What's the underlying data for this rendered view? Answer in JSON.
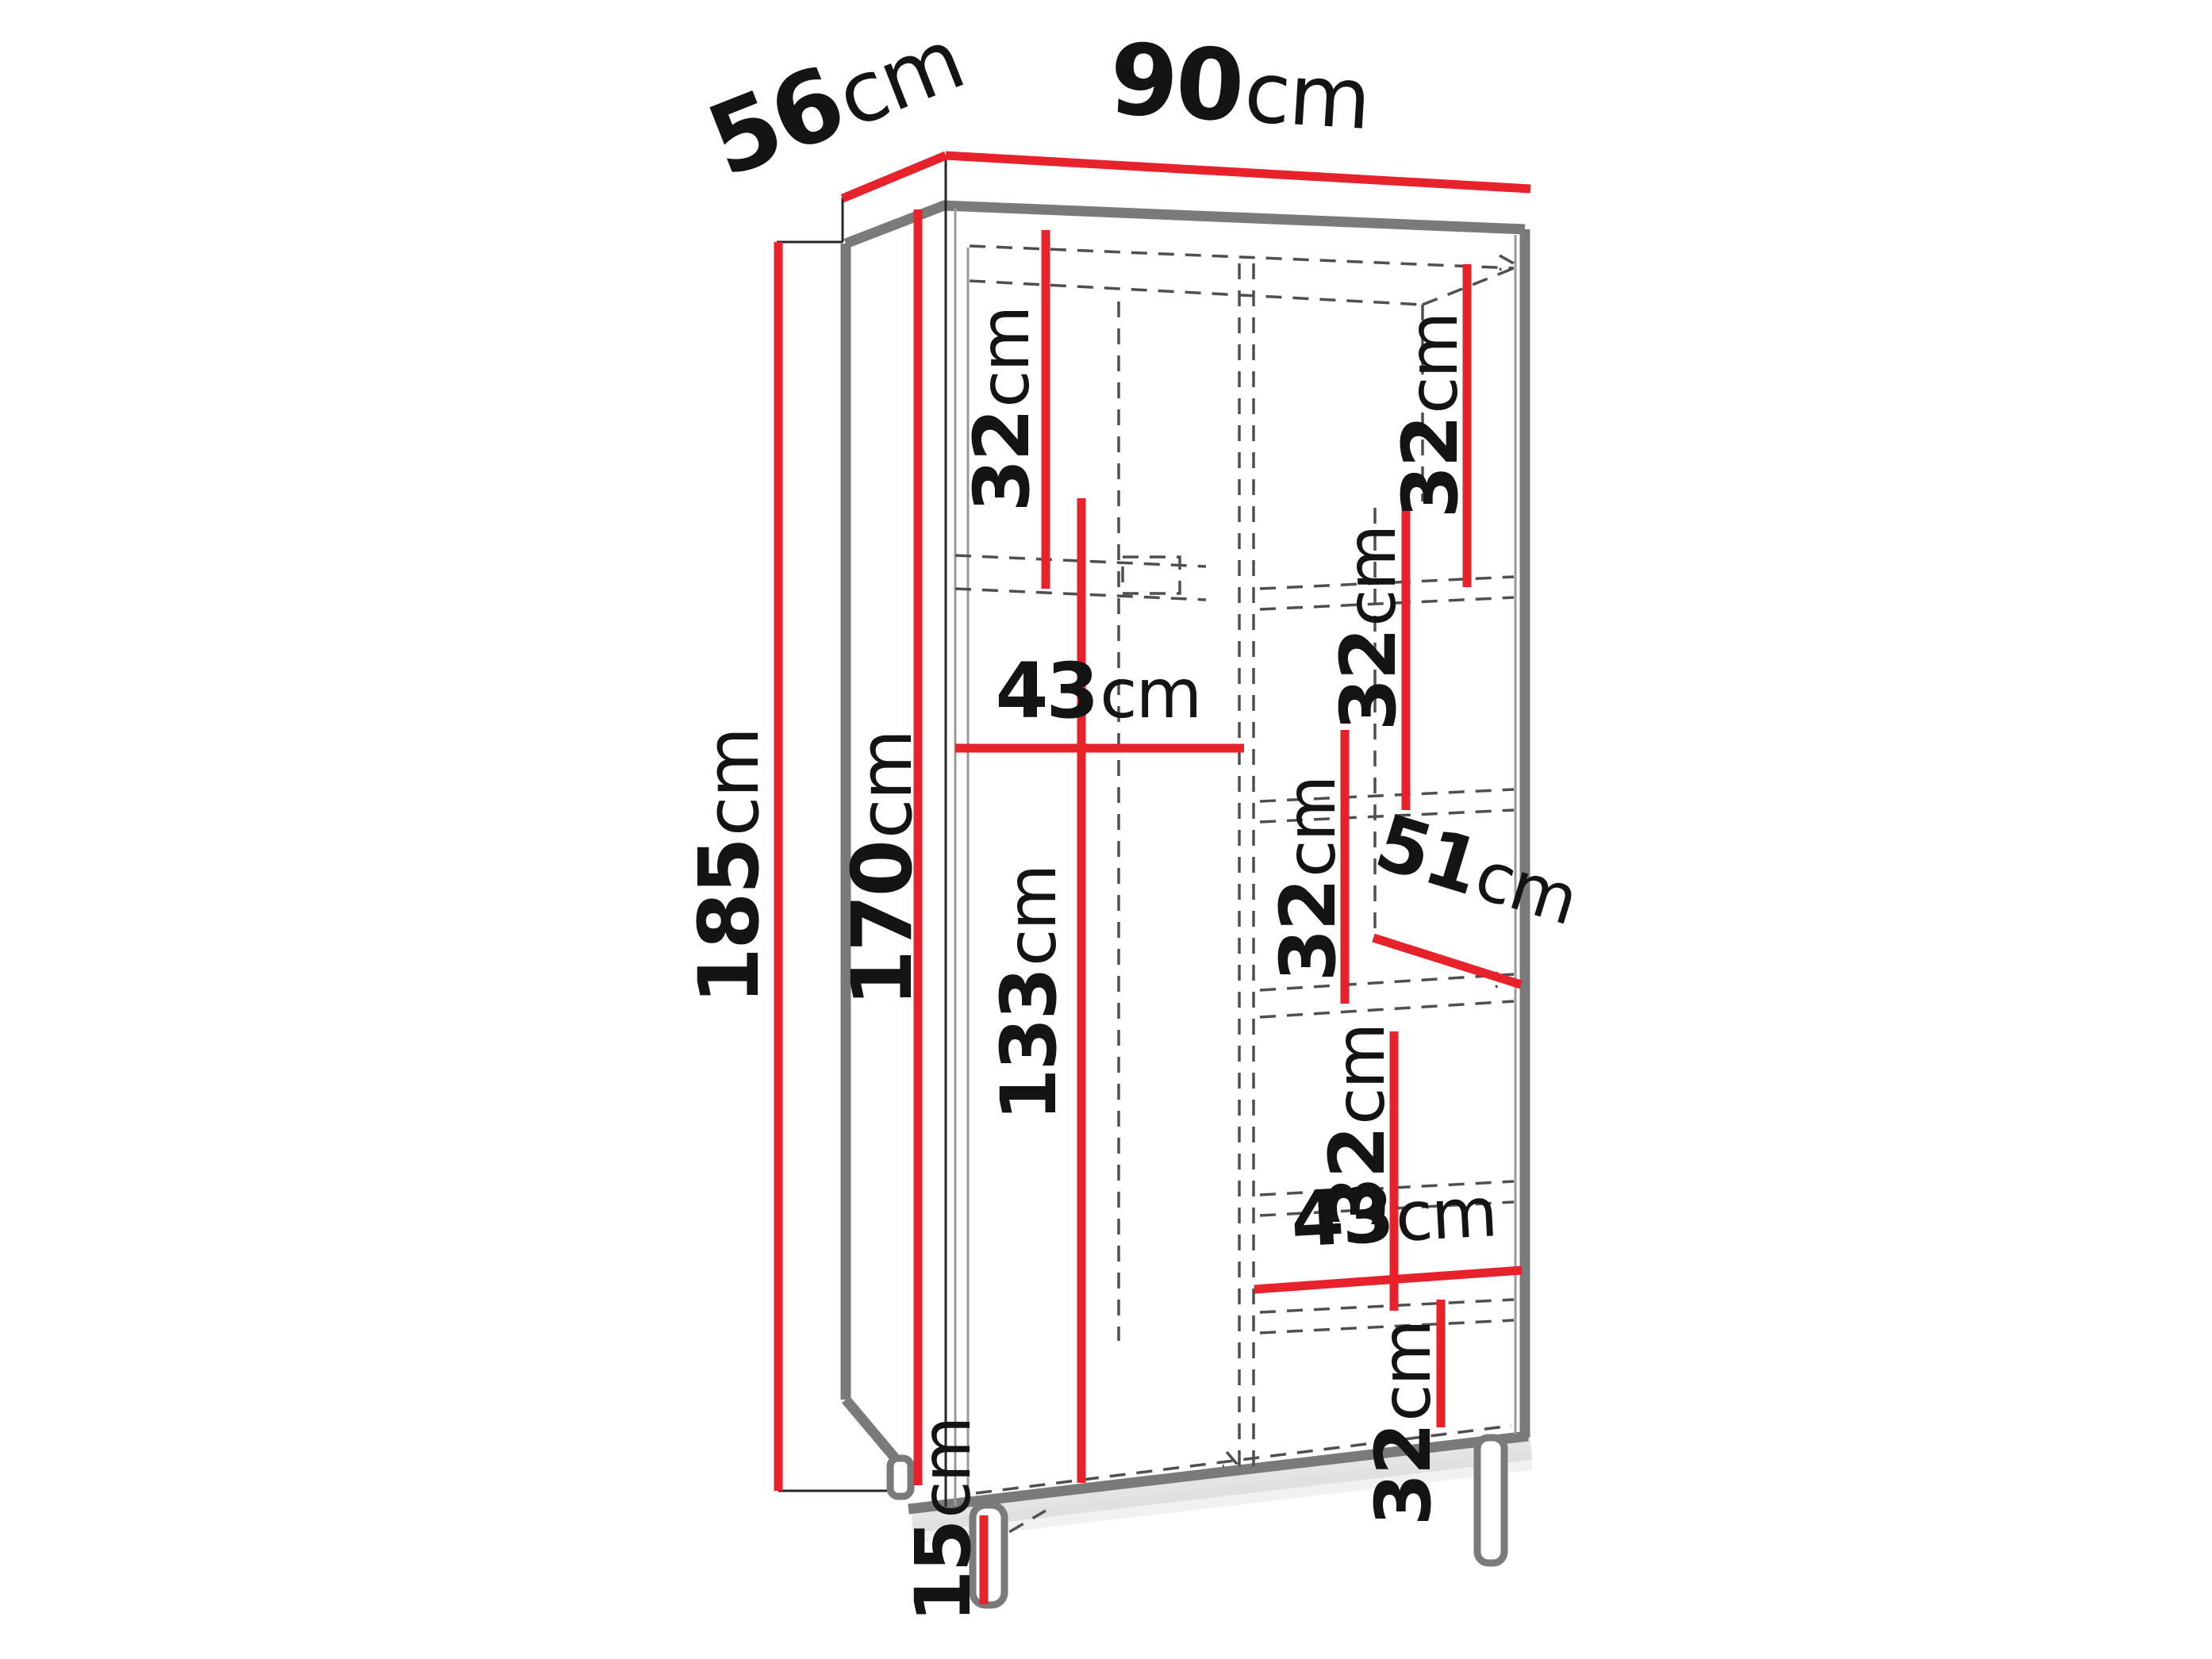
{
  "page": {
    "type": "furniture-dimension-diagram",
    "subject": "wardrobe interior dimension drawing",
    "background": "#ffffff"
  },
  "colors": {
    "dimension_line": "#e8222a",
    "carcass_edge": "#7a7a7a",
    "hidden_edge": "#4f4f4f",
    "label_text": "#141414"
  },
  "dims": {
    "width": {
      "value": "90",
      "unit": "cm"
    },
    "depth": {
      "value": "56",
      "unit": "cm"
    },
    "total_height": {
      "value": "185",
      "unit": "cm"
    },
    "carcass_height": {
      "value": "170",
      "unit": "cm"
    },
    "left_top_shelf": {
      "value": "32",
      "unit": "cm"
    },
    "left_width": {
      "value": "43",
      "unit": "cm"
    },
    "hanging_space": {
      "value": "133",
      "unit": "cm"
    },
    "leg_height": {
      "value": "15",
      "unit": "cm"
    },
    "right_shelf_1": {
      "value": "32",
      "unit": "cm"
    },
    "right_shelf_2": {
      "value": "32",
      "unit": "cm"
    },
    "right_shelf_3": {
      "value": "32",
      "unit": "cm"
    },
    "shelf_depth": {
      "value": "51",
      "unit": "cm"
    },
    "right_shelf_4": {
      "value": "32",
      "unit": "cm"
    },
    "right_width": {
      "value": "43",
      "unit": "cm"
    },
    "right_shelf_5": {
      "value": "32",
      "unit": "cm"
    }
  }
}
